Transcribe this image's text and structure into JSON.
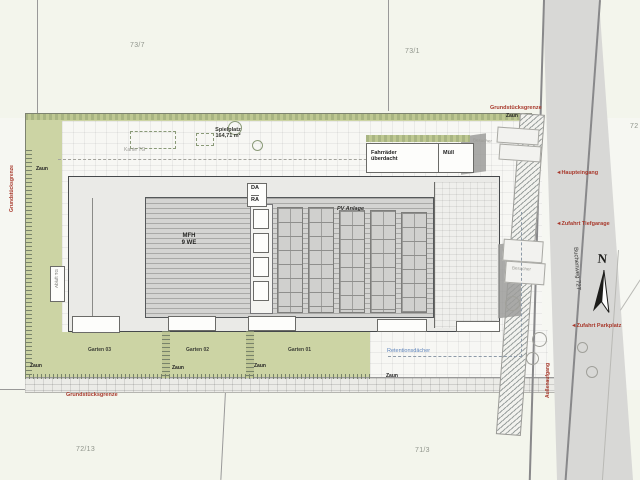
{
  "parcels": {
    "top_left": "73/7",
    "top_right": "73/1",
    "bottom_left": "72/13",
    "bottom_right": "71/3",
    "right_edge": "72"
  },
  "labels": {
    "grenze": "Grundstücksgrenze",
    "zaun": "Zaun",
    "spielplatz_line1": "Spielplatz",
    "spielplatz_line2": "164,71 m²",
    "kante_tg": "Kante TG",
    "abluft_tg": "Abluft TG",
    "da": "DA",
    "ra": "RA",
    "mfh_line1": "MFH",
    "mfh_line2": "9 WE",
    "pv": "PV Anlage",
    "fahrraeder_line1": "Fahrräder",
    "fahrraeder_line2": "überdacht",
    "muell": "Müll",
    "besucher": "Besucher",
    "retention": "Retentionsdächer",
    "gardens": [
      "Garten 03",
      "Garten 02",
      "Garten 01"
    ],
    "haupteingang": "Haupteingang",
    "zufahrt_tiefgarage": "Zufahrt Tiefgarage",
    "zufahrt_parkplatz": "Zufahrt Parkplatz",
    "aufgang": "Außenaufgang",
    "strasse": "Buchenweg 727",
    "north": "N",
    "arrow": "◄"
  },
  "colors": {
    "site_green": "#ccd4a4",
    "boundary_red": "#a8392c",
    "retention_blue": "#5d83bb",
    "road_grey": "#d8d8d6"
  }
}
